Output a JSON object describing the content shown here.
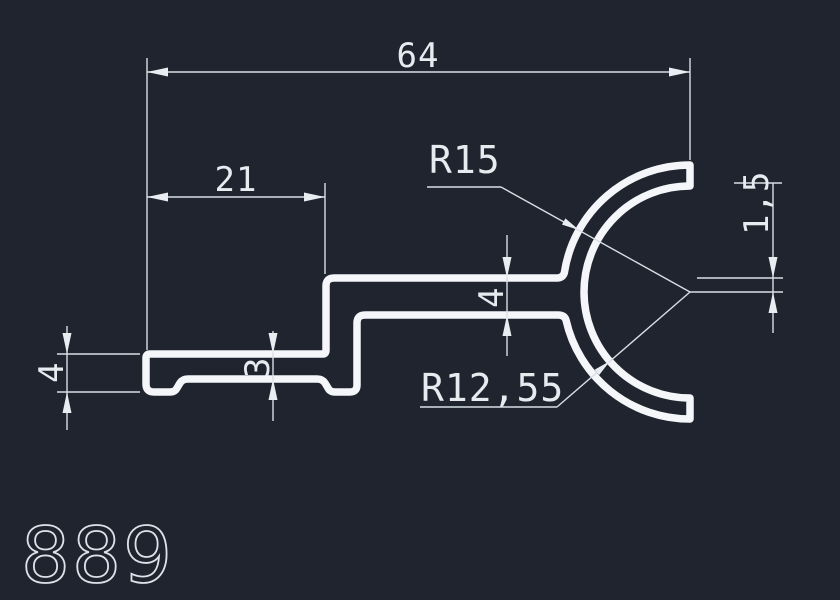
{
  "canvas": {
    "background_color": "#1f242e",
    "profile_line_color": "#f4f6f9",
    "dimension_line_color": "#d9dee5",
    "text_color": "#e7ebf0"
  },
  "drawing": {
    "part_number": "889",
    "dimensions": {
      "overall_width": "64",
      "foot_length": "21",
      "outer_radius": "R15",
      "inner_radius": "R12,55",
      "web_thickness": "4",
      "foot_thickness": "4",
      "lip_thickness": "3",
      "center_offset": "1,5"
    }
  }
}
